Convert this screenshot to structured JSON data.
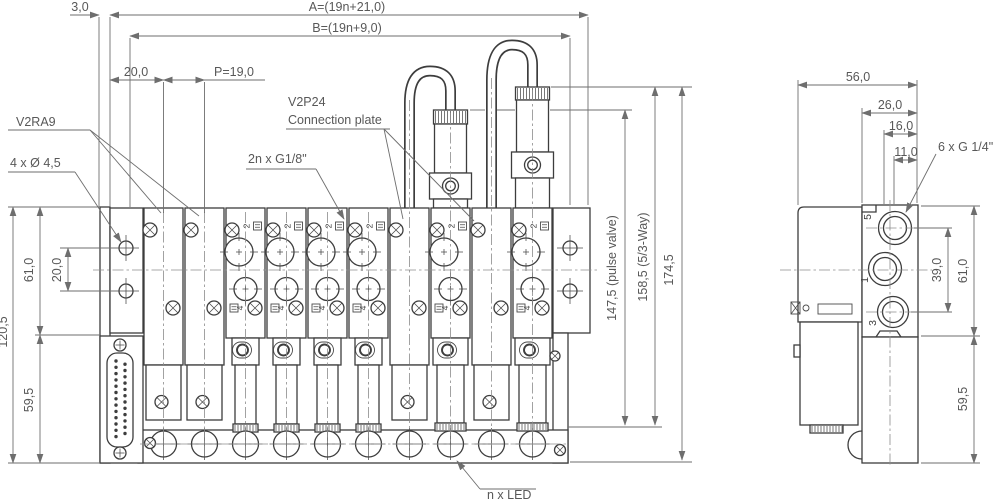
{
  "drawing": {
    "dims_top": {
      "offset": "3,0",
      "overall_a": "A=(19n+21,0)",
      "overall_b": "B=(19n+9,0)",
      "first_station": "20,0",
      "pitch": "P=19,0"
    },
    "dims_left": {
      "total_height": "120,5",
      "upper_height": "61,0",
      "lower_height": "59,5",
      "hole_spacing": "20,0"
    },
    "dims_right": {
      "pulse_valve_height": "147,5 (pulse valve)",
      "way53_height": "158,5 (5/3-Way)",
      "total_height": "174,5"
    },
    "dims_side": {
      "depth": "56,0",
      "subbase_depth": "26,0",
      "port1_offset": "16,0",
      "port5_offset": "11,0",
      "port_thread": "6 x G 1/4\"",
      "port_span": "39,0",
      "upper_height": "61,0",
      "lower_height": "59,5"
    },
    "callouts": {
      "blank_plate": "V2RA9",
      "mounting_holes": "4 x Ø 4,5",
      "working_ports": "2n x G1/8\"",
      "connection_plate_line1": "V2P24",
      "connection_plate_line2": "Connection plate",
      "led": "n x LED"
    },
    "port_numbers": {
      "p2": "2",
      "p4": "4",
      "p5": "5",
      "p1": "1",
      "p3": "3"
    },
    "stations": [
      "blank",
      "blank",
      "valve",
      "valve",
      "valve",
      "valve",
      "blank",
      "tower",
      "blank",
      "tower"
    ]
  }
}
